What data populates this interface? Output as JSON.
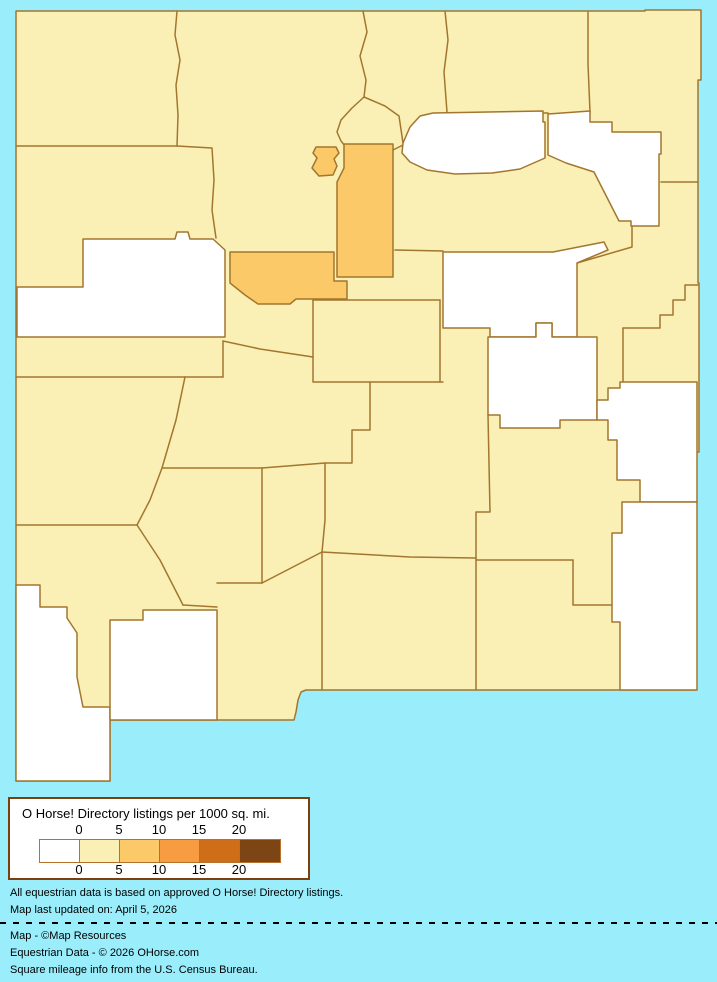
{
  "map": {
    "description": "Choropleth map of New Mexico counties shaded by O Horse! Directory listings per 1000 sq. mi.",
    "background_color": "#9AEEFB",
    "border_color": "#A2762F",
    "category_colors": {
      "0": "#FFFFFF",
      "0-5": "#FAF0B5",
      "5-10": "#FBC967",
      "10-15": "#F89C42",
      "15-20": "#CE6E19",
      "20+": "#7D4514"
    },
    "base_fill_category": "0-5",
    "state_outline": "16,11 645,11 645,10 701,10 701,80 698,80 698,283 699,283 699,452 696,452 696,690 306,690 301,692 298,700 296,712 294,720 110,720 110,781 16,781",
    "counties": [
      {
        "id": "mckinley",
        "category": "0",
        "points": "83,239 175,239 177,232 188,232 190,239 213,239 225,250 225,337 17,337 17,287 83,287"
      },
      {
        "id": "mora",
        "category": "0",
        "points": "403,143 410,127 420,116 433,113 543,111 543,122 545,122 545,158 520,169 492,173 455,174 427,170 410,162 402,153"
      },
      {
        "id": "harding",
        "category": "0",
        "points": "548,114 590,111 590,122 612,122 612,132 661,132 661,154 659,154 659,226 631,226 631,221 619,221 594,172 566,163 548,155"
      },
      {
        "id": "guadalupe",
        "category": "0",
        "points": "443,252 553,252 604,242 608,250 577,263 577,337 552,337 552,323 536,323 536,337 490,337 490,328 443,328"
      },
      {
        "id": "de-baca",
        "category": "0",
        "points": "488,337 536,337 536,323 552,323 552,337 597,337 597,420 560,420 560,428 500,428 500,415 488,415"
      },
      {
        "id": "roosevelt",
        "category": "0",
        "points": "620,382 697,382 697,502 640,502 640,480 617,480 617,440 608,440 608,420 597,420 597,400 608,400 608,388 620,388"
      },
      {
        "id": "lea",
        "category": "0",
        "points": "622,502 697,502 697,690 620,690 620,622 612,622 612,533 622,533"
      },
      {
        "id": "hidalgo-grant-west",
        "category": "0",
        "points": "16,585 40,585 40,607 67,607 67,618 77,633 77,677 83,707 110,707 110,781 16,781"
      },
      {
        "id": "luna",
        "category": "0",
        "points": "110,620 143,620 143,610 217,610 217,720 110,720"
      },
      {
        "id": "santa-fe",
        "category": "5-10",
        "points": "344,144 393,144 393,277 337,277 337,182 344,168"
      },
      {
        "id": "los-alamos",
        "category": "5-10",
        "points": "316,147 336,147 339,153 334,159 337,166 333,175 319,176 312,168 317,158 313,153"
      },
      {
        "id": "bernalillo",
        "category": "5-10",
        "points": "230,252 334,252 334,281 347,281 347,299 296,299 290,304 258,304 245,295 230,283"
      }
    ],
    "border_lines": [
      "M16,146 L177,146",
      "M177,11 L175,35 L180,60 L176,85 L178,115 L177,146",
      "M177,146 L212,148 L214,180 L212,210 L216,238",
      "M363,11 L367,32 L360,56 L366,80 L364,97",
      "M364,97 L352,108 L341,120 L337,132 L341,141 L345,146",
      "M364,97 L385,106 L399,116 L403,143",
      "M445,11 L448,40 L444,72 L447,112",
      "M447,113 L548,113",
      "M588,12 L588,64 L590,112",
      "M661,182 L698,182",
      "M577,263 L632,247 L632,226",
      "M623,328 L660,328 L660,315 L673,315 L673,300 L685,300 L685,285 L698,285",
      "M623,328 L623,382",
      "M395,250 L443,251",
      "M393,150 L403,145",
      "M16,377 L223,377",
      "M223,341 L223,377",
      "M223,341 L260,349 L313,357",
      "M185,377 L176,420 L162,468 L150,500 L137,525",
      "M162,468 L262,468",
      "M262,468 L262,583",
      "M16,525 L137,525",
      "M137,525 L160,560 L183,605",
      "M183,605 L217,607",
      "M217,583 L262,583",
      "M262,583 L322,552",
      "M322,552 L322,690",
      "M313,300 L313,382",
      "M313,300 L440,300",
      "M314,382 L443,382",
      "M440,300 L440,382",
      "M370,382 L370,430 L352,430 L352,463 L325,463 L325,520 L322,552",
      "M262,468 L325,463",
      "M488,415 L490,512 L476,512 L476,558",
      "M322,552 L410,557 L476,558",
      "M476,558 L476,690",
      "M476,560 L573,560",
      "M573,560 L573,605 L612,605"
    ]
  },
  "legend": {
    "title": "O Horse! Directory listings per 1000 sq. mi.",
    "ticks": [
      "0",
      "5",
      "10",
      "15",
      "20"
    ],
    "ramp_colors": [
      "#FFFFFF",
      "#FAF0B5",
      "#FBC967",
      "#F89C42",
      "#CE6E19",
      "#7D4514"
    ],
    "box_border_color": "#7B3F10",
    "ramp_border_color": "#B5722D"
  },
  "footer": {
    "note1": "All equestrian data is based on approved O Horse! Directory listings.",
    "note2": "Map last updated on: April 5, 2026",
    "credit1": "Map - ©Map Resources",
    "credit2": "Equestrian Data - © 2026 OHorse.com",
    "credit3": "Square mileage info from the U.S. Census Bureau."
  }
}
